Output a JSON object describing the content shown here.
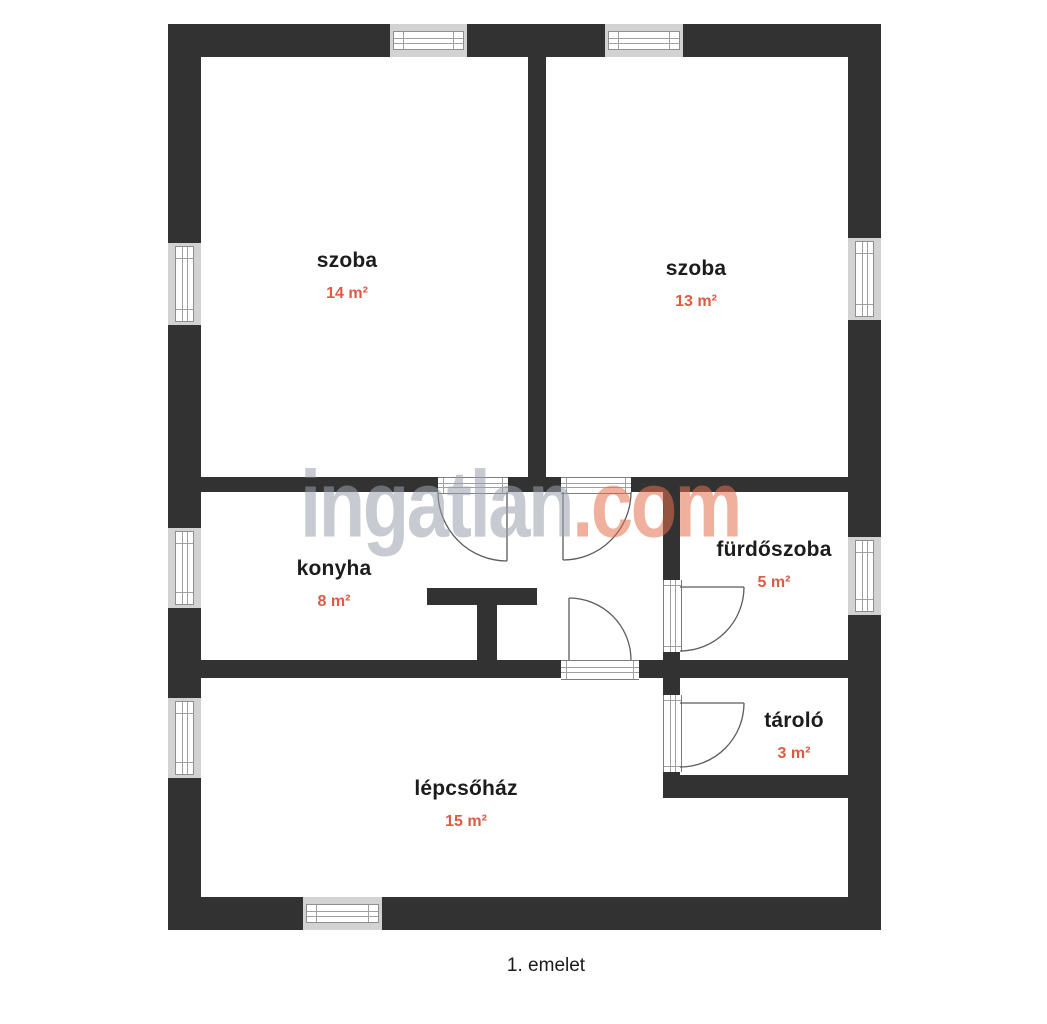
{
  "page": {
    "caption": "1. emelet"
  },
  "watermark": {
    "name": "ingatlan",
    "tld": ".com"
  },
  "rooms": [
    {
      "name": "szoba",
      "area": "14 m²"
    },
    {
      "name": "szoba",
      "area": "13 m²"
    },
    {
      "name": "konyha",
      "area": "8 m²"
    },
    {
      "name": "fürdőszoba",
      "area": "5 m²"
    },
    {
      "name": "tároló",
      "area": "3 m²"
    },
    {
      "name": "lépcsőház",
      "area": "15 m²"
    }
  ],
  "colors": {
    "wall": "#323232",
    "room_text": "#1c1c1c",
    "area_text": "#dd5b43",
    "window_fill": "#d2d2d2",
    "watermark_name": "#9aa0ac",
    "watermark_tld": "#e4704f",
    "door_line": "#5b5b5b"
  }
}
